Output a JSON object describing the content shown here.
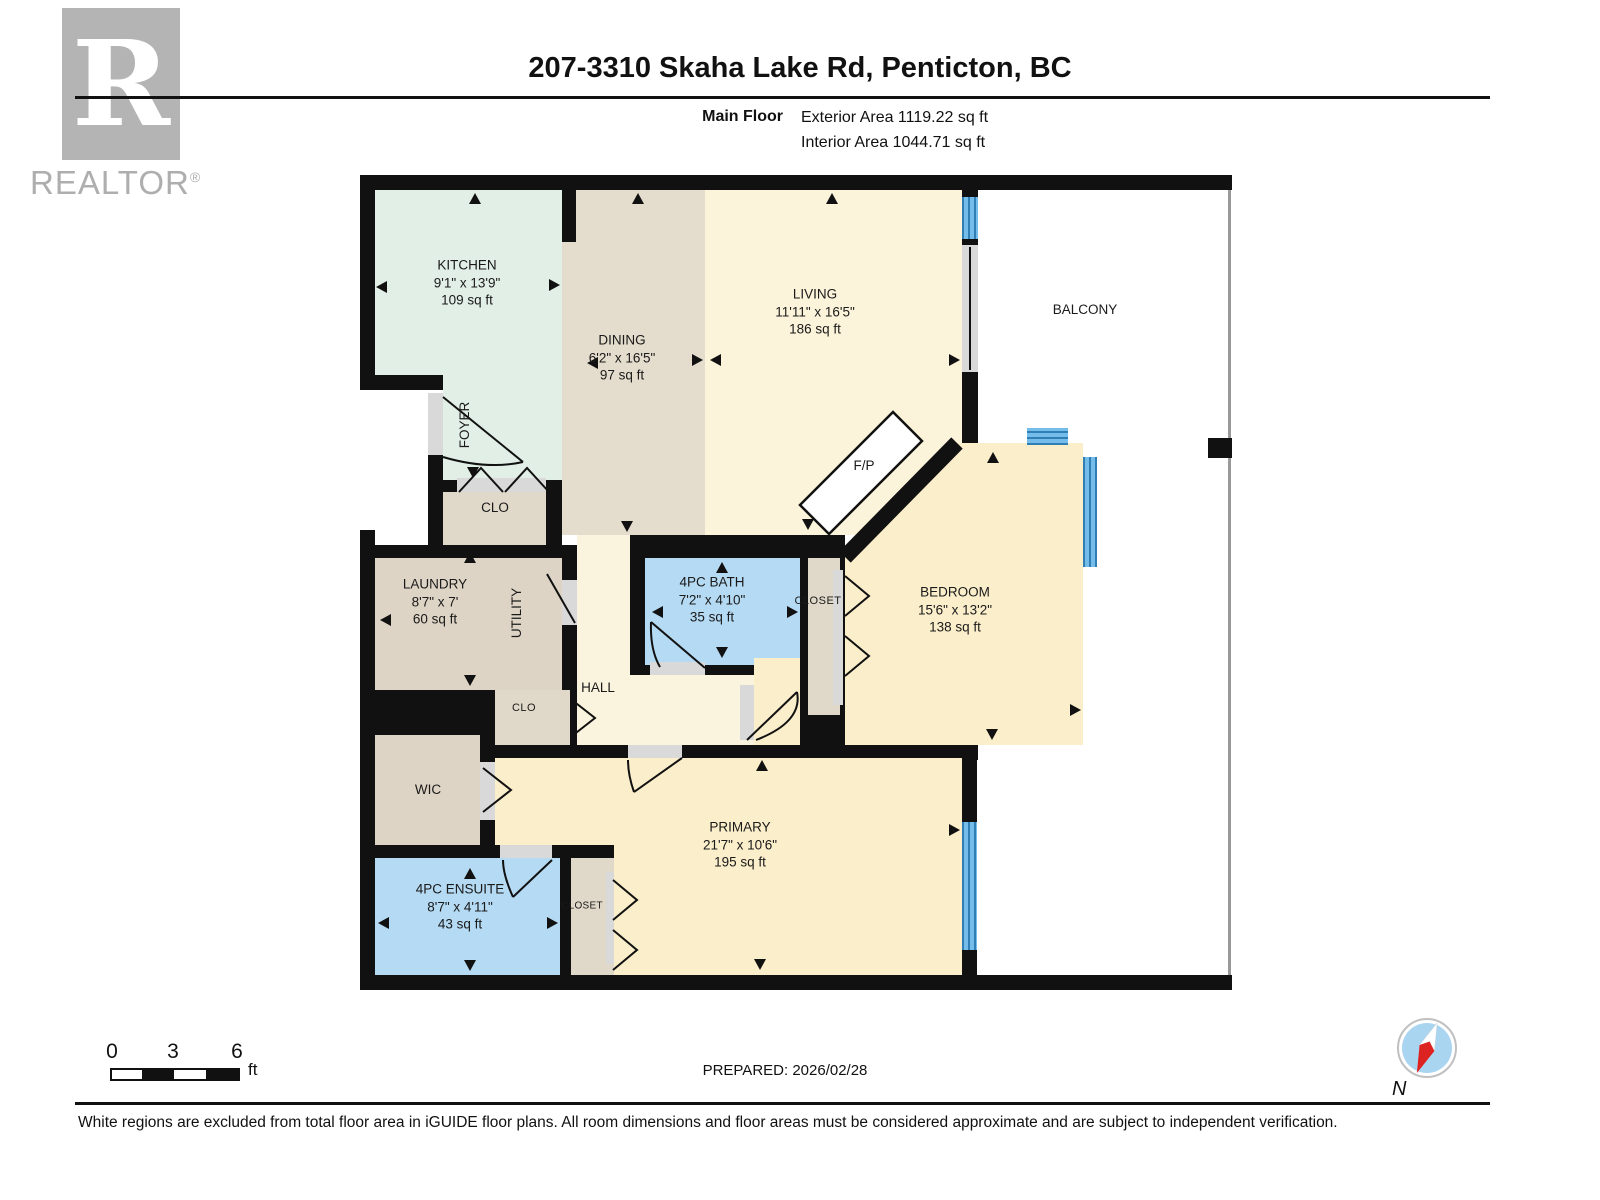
{
  "header": {
    "logo_text": "REALTOR",
    "logo_reg": "®",
    "logo_letter": "R",
    "title": "207-3310 Skaha Lake Rd, Penticton, BC",
    "floor_label": "Main Floor",
    "exterior_area": "Exterior Area 1119.22 sq ft",
    "interior_area": "Interior Area 1044.71 sq ft"
  },
  "rooms": {
    "kitchen": {
      "name": "KITCHEN",
      "dims": "9'1\" x 13'9\"",
      "area": "109 sq ft"
    },
    "dining": {
      "name": "DINING",
      "dims": "6'2\" x 16'5\"",
      "area": "97 sq ft"
    },
    "living": {
      "name": "LIVING",
      "dims": "11'11\" x 16'5\"",
      "area": "186 sq ft"
    },
    "balcony": {
      "name": "BALCONY"
    },
    "foyer": {
      "name": "FOYER"
    },
    "clo_entry": {
      "name": "CLO"
    },
    "laundry": {
      "name": "LAUNDRY",
      "dims": "8'7\" x 7'",
      "area": "60 sq ft"
    },
    "utility": {
      "name": "UTILITY"
    },
    "bath": {
      "name": "4PC BATH",
      "dims": "7'2\" x 4'10\"",
      "area": "35 sq ft"
    },
    "closet_bedroom": {
      "name": "CLOSET"
    },
    "bedroom": {
      "name": "BEDROOM",
      "dims": "15'6\" x 13'2\"",
      "area": "138 sq ft"
    },
    "hall": {
      "name": "HALL"
    },
    "clo_hall": {
      "name": "CLO"
    },
    "wic": {
      "name": "WIC"
    },
    "ensuite": {
      "name": "4PC ENSUITE",
      "dims": "8'7\" x 4'11\"",
      "area": "43 sq ft"
    },
    "closet_primary": {
      "name": "CLOSET"
    },
    "primary": {
      "name": "PRIMARY",
      "dims": "21'7\" x 10'6\"",
      "area": "195 sq ft"
    },
    "fireplace": {
      "name": "F/P"
    }
  },
  "footer": {
    "scale": {
      "ticks": [
        "0",
        "3",
        "6"
      ],
      "unit": "ft"
    },
    "prepared": "PREPARED: 2026/02/28",
    "compass_label": "N",
    "disclaimer": "White regions are excluded from total floor area in iGUIDE floor plans. All room dimensions and floor areas must be considered approximate and are subject to independent verification."
  },
  "colors": {
    "wall": "#111111",
    "kitchen": "#e2efe6",
    "dining_tan": "#e4dccc",
    "closet_tan": "#e0d8c8",
    "laundry_tan": "#ddd4c5",
    "living_cream": "#fbf3da",
    "bedroom_cream": "#fbeecb",
    "hall_cream": "#faf3dd",
    "bath_blue": "#b5daf3",
    "window_blue": "#5fade2",
    "opening_gray": "#d9d9d9",
    "railing_gray": "#999999",
    "compass_blue": "#a9d5f1",
    "compass_red": "#dd2222",
    "logo_gray": "#b4b4b4"
  }
}
